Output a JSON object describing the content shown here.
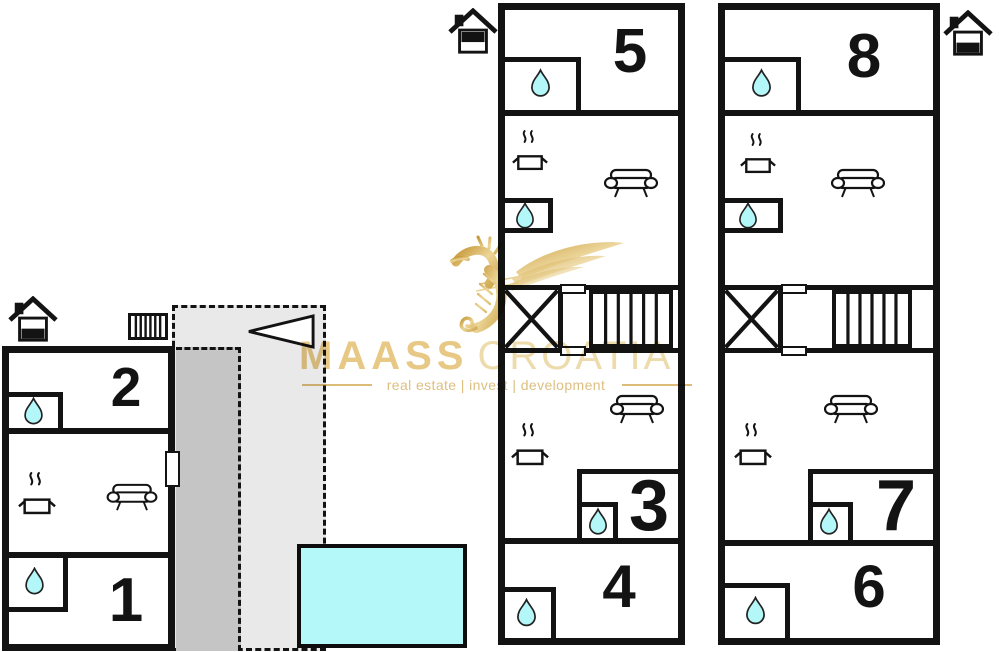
{
  "watermark": {
    "brand": "MAASS",
    "brand_secondary": "CROATIA",
    "tagline": "real estate | invest | development"
  },
  "plan": {
    "left_unit": {
      "rooms": [
        {
          "label": "2"
        },
        {
          "label": "1"
        }
      ]
    },
    "middle_unit": {
      "rooms": [
        {
          "label": "5"
        },
        {
          "label": "3"
        },
        {
          "label": "4"
        }
      ]
    },
    "right_unit": {
      "rooms": [
        {
          "label": "8"
        },
        {
          "label": "7"
        },
        {
          "label": "6"
        }
      ]
    }
  },
  "colors": {
    "wall": "#131313",
    "water_cyan": "#b4f8f9",
    "terrace_light_gray": "#e9e9e9",
    "terrace_dark_gray": "#c5c5c5",
    "brand_gold": "#e7c885",
    "brand_gold_light": "#eedbab"
  },
  "icons": {
    "shower": "water-drop-icon",
    "kitchen": "cooking-pot-steam-icon",
    "lounge": "sofa-icon",
    "stairwell": "x-cross-icon",
    "stairs": "stairs-icon",
    "entrance_marker": "house-icon",
    "heating": "radiator-icon",
    "direction": "left-triangle-arrow-icon",
    "logo": "seahorse-icon",
    "pool": "swimming-pool"
  }
}
